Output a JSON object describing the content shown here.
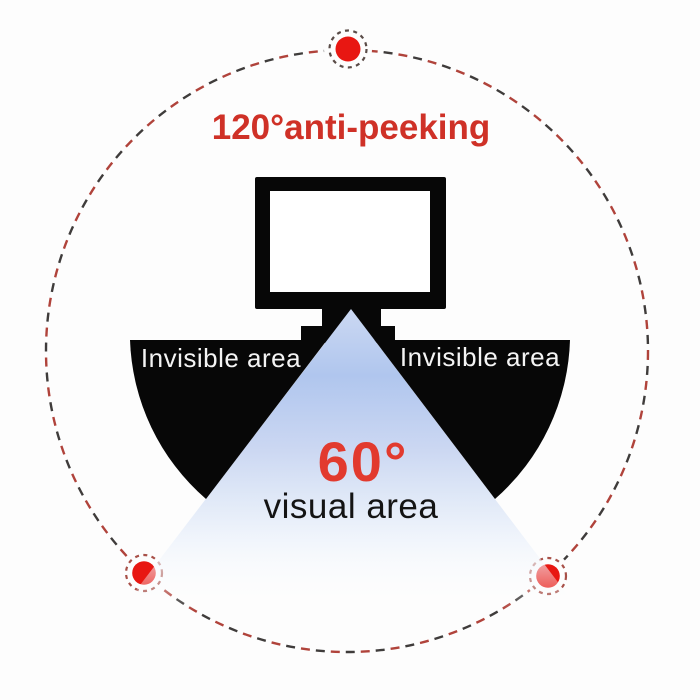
{
  "title": "120°anti-peeking",
  "scene": {
    "invisible_left": "Invisible area",
    "invisible_right": "Invisible area",
    "angle_label": "60°",
    "visual_label": "visual area"
  },
  "icons": {
    "monitor": "monitor-icon",
    "marker_dot": "red-dot-icon"
  },
  "colors": {
    "title_red": "#cf3127",
    "angle_red": "#e23a2e",
    "dot_red": "#e81712",
    "dash_red": "#b0433b",
    "dash_dark": "#3f3c3b",
    "ring_red": "#a85048",
    "ring_dark": "#5a4c48",
    "ink_black": "#070707",
    "text_white": "#f4f4f4",
    "text_dark": "#141414",
    "cone_blue": "#b0c6ee"
  }
}
